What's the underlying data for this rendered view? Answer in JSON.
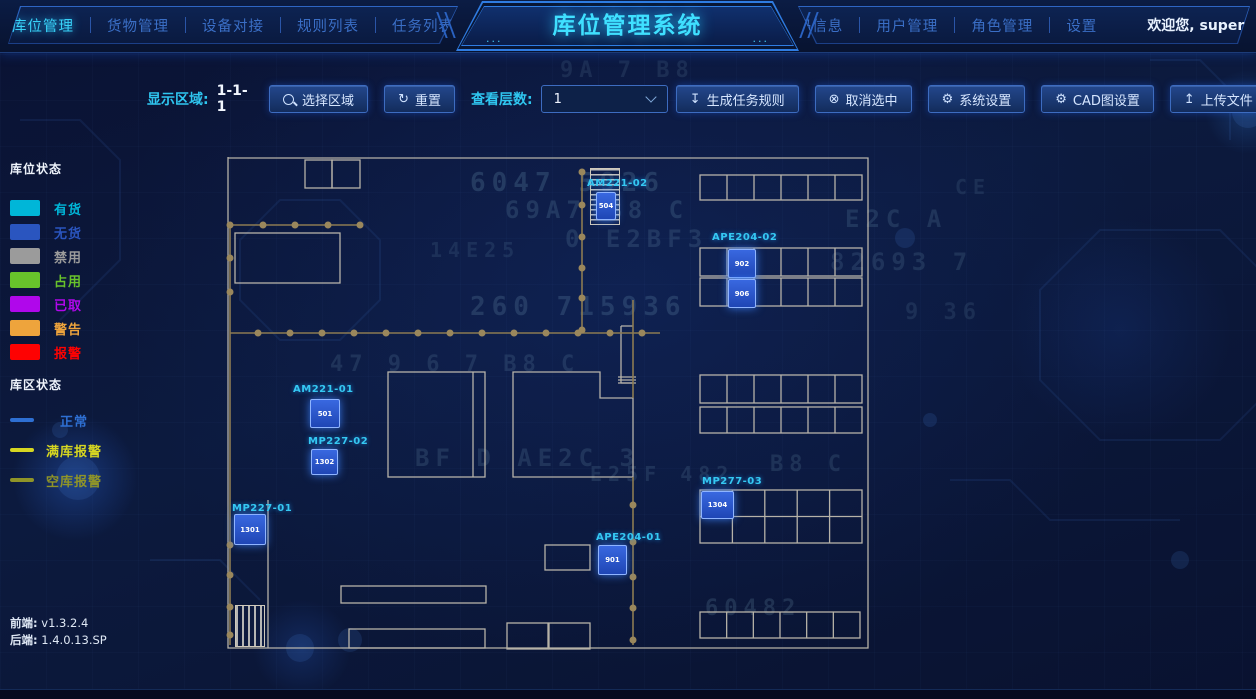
{
  "app": {
    "title": "库位管理系统",
    "welcome": "欢迎您, super",
    "title_dots": "···"
  },
  "icons": {
    "refresh": "↻",
    "generate": "↧",
    "cancel": "⊗",
    "gear": "⚙",
    "upload": "↥",
    "caret": "▼"
  },
  "nav": {
    "left": [
      {
        "label": "库位管理",
        "active": true
      },
      {
        "label": "货物管理",
        "active": false
      },
      {
        "label": "设备对接",
        "active": false
      },
      {
        "label": "规则列表",
        "active": false
      },
      {
        "label": "任务列表",
        "active": false
      }
    ],
    "right": [
      {
        "label": "扫码信息"
      },
      {
        "label": "用户管理"
      },
      {
        "label": "角色管理"
      },
      {
        "label": "设置"
      }
    ]
  },
  "toolbar": {
    "display_area_label": "显示区域:",
    "display_area_value": "1-1-1",
    "select_area_btn": "选择区域",
    "reset_btn": "重置",
    "layer_label": "查看层数:",
    "layer_value": "1",
    "generate_rule_btn": "生成任务规则",
    "cancel_select_btn": "取消选中",
    "system_settings_btn": "系统设置",
    "cad_settings_btn": "CAD图设置",
    "upload_btn": "上传文件"
  },
  "legend_slot": {
    "title": "库位状态",
    "items": [
      {
        "label": "有货",
        "color": "#00b6d8"
      },
      {
        "label": "无货",
        "color": "#2a55bf"
      },
      {
        "label": "禁用",
        "color": "#9b9b9b"
      },
      {
        "label": "占用",
        "color": "#68c32b"
      },
      {
        "label": "已取",
        "color": "#b007eb"
      },
      {
        "label": "警告",
        "color": "#eea43c"
      },
      {
        "label": "报警",
        "color": "#fe0202"
      }
    ]
  },
  "legend_zone": {
    "title": "库区状态",
    "items": [
      {
        "label": "正常",
        "color": "#2e6fd2"
      },
      {
        "label": "满库报警",
        "color": "#d6d621"
      },
      {
        "label": "空库报警",
        "color": "#8f9428"
      }
    ]
  },
  "versions": {
    "front_label": "前端:",
    "front": "v1.3.2.4",
    "back_label": "后端:",
    "back": "1.4.0.13.SP"
  },
  "map": {
    "units": [
      {
        "label": "AM221-02",
        "cell": "504"
      },
      {
        "label": "APE204-02",
        "cell_top": "902",
        "cell_bottom": "906"
      },
      {
        "label": "AM221-01",
        "cell": "501"
      },
      {
        "label": "MP227-02",
        "cell": "1302"
      },
      {
        "label": "MP227-01",
        "cell": "1301"
      },
      {
        "label": "MP277-03",
        "cell": "1304"
      },
      {
        "label": "APE204-01",
        "cell": "901"
      }
    ]
  },
  "decor_glyphs": [
    {
      "t": "6047 5926",
      "x": 470,
      "y": 168,
      "s": 26,
      "o": 0.16
    },
    {
      "t": "69A7 B8 C",
      "x": 505,
      "y": 196,
      "s": 24,
      "o": 0.14
    },
    {
      "t": "0 E2BF3",
      "x": 565,
      "y": 225,
      "s": 24,
      "o": 0.13
    },
    {
      "t": "14E25",
      "x": 430,
      "y": 238,
      "s": 20,
      "o": 0.1
    },
    {
      "t": "260 715936",
      "x": 470,
      "y": 292,
      "s": 26,
      "o": 0.15
    },
    {
      "t": "47 9 6 7 B8 C",
      "x": 330,
      "y": 352,
      "s": 22,
      "o": 0.12
    },
    {
      "t": "BF D AE2C 3",
      "x": 415,
      "y": 444,
      "s": 24,
      "o": 0.13
    },
    {
      "t": "E25F 482",
      "x": 590,
      "y": 462,
      "s": 20,
      "o": 0.12
    },
    {
      "t": "B8 C",
      "x": 770,
      "y": 452,
      "s": 22,
      "o": 0.12
    },
    {
      "t": "E2C A",
      "x": 845,
      "y": 205,
      "s": 24,
      "o": 0.13
    },
    {
      "t": "82693 7",
      "x": 830,
      "y": 248,
      "s": 24,
      "o": 0.12
    },
    {
      "t": "9 36",
      "x": 905,
      "y": 300,
      "s": 22,
      "o": 0.1
    },
    {
      "t": "60482",
      "x": 705,
      "y": 596,
      "s": 22,
      "o": 0.14
    },
    {
      "t": "9A 7 B8",
      "x": 560,
      "y": 58,
      "s": 22,
      "o": 0.1
    },
    {
      "t": "D 4 2",
      "x": 600,
      "y": 34,
      "s": 20,
      "o": 0.09
    },
    {
      "t": "CE",
      "x": 955,
      "y": 175,
      "s": 20,
      "o": 0.1
    }
  ]
}
